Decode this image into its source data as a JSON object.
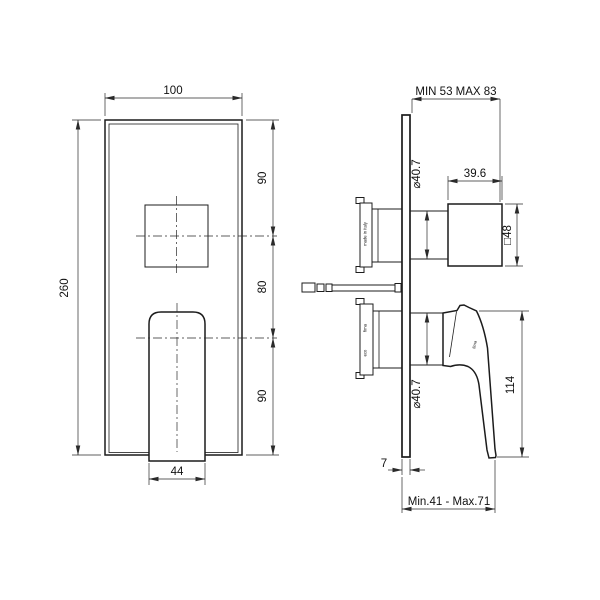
{
  "drawing": {
    "front": {
      "plate_width": "100",
      "plate_height": "260",
      "segment_top": "90",
      "segment_middle": "80",
      "segment_bottom": "90",
      "handle_width": "44"
    },
    "side": {
      "install_depth_range": "MIN 53 MAX 83",
      "knob_depth": "39.6",
      "knob_square_size": "□48",
      "upper_cartridge_diameter": "⌀40.7",
      "lower_cartridge_diameter": "⌀40.7",
      "handle_height": "114",
      "plate_thickness": "7",
      "handle_projection_range": "Min.41 - Max.71"
    },
    "marks": {
      "made_in_italy": "made in Italy",
      "brand_upper": "fima",
      "brand_lower": "eco",
      "brand_handle": "fima"
    }
  }
}
